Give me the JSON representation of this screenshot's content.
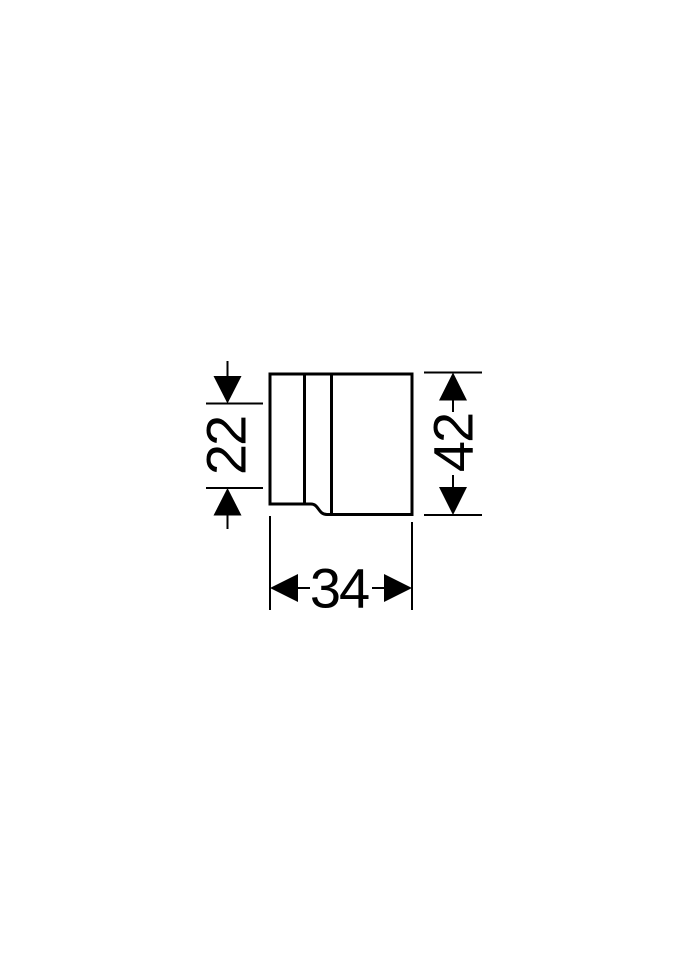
{
  "drawing": {
    "kind": "technical-dimension-drawing",
    "colors": {
      "line": "#000000",
      "background": "#ffffff"
    },
    "dimensions": {
      "left": {
        "value": "22"
      },
      "right": {
        "value": "42"
      },
      "bottom": {
        "value": "34"
      }
    }
  }
}
